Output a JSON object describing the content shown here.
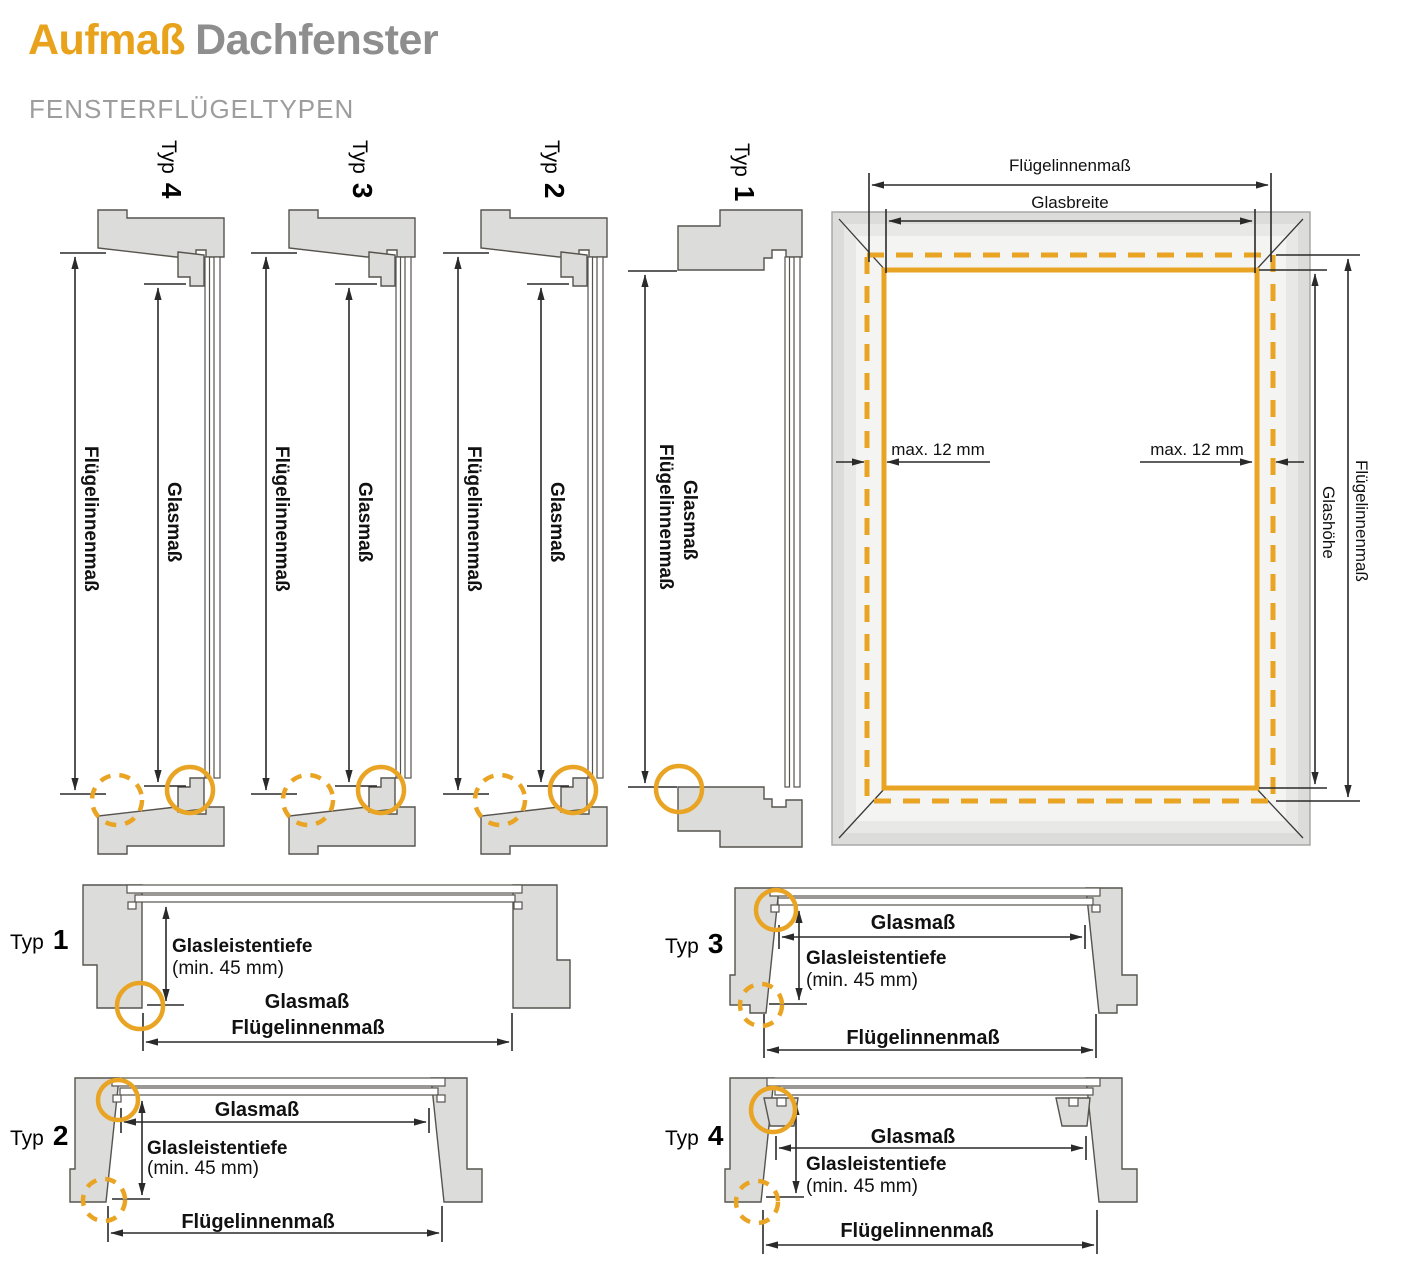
{
  "header": {
    "title_accent": "Aufmaß",
    "title_rest": "Dachfenster",
    "subtitle": "FENSTERFLÜGELTYPEN"
  },
  "profile_sections_top": [
    {
      "typ": "Typ",
      "num": "4",
      "dim_outer": "Flügelinnenmaß",
      "dim_inner": "Glasmaß"
    },
    {
      "typ": "Typ",
      "num": "3",
      "dim_outer": "Flügelinnenmaß",
      "dim_inner": "Glasmaß"
    },
    {
      "typ": "Typ",
      "num": "2",
      "dim_outer": "Flügelinnenmaß",
      "dim_inner": "Glasmaß"
    },
    {
      "typ": "Typ",
      "num": "1",
      "dim_outer": "Flügelinnenmaß",
      "dim_inner": "Glasmaß"
    }
  ],
  "front_view": {
    "dim_top_outer": "Flügelinnenmaß",
    "dim_top_inner": "Glasbreite",
    "dim_right_outer": "Flügelinnenmaß",
    "dim_right_inner": "Glashöhe",
    "gap_left": "max. 12 mm",
    "gap_right": "max. 12 mm"
  },
  "detail_sections_bottom": [
    {
      "typ": "Typ",
      "num": "1",
      "depth": "Glasleistentiefe",
      "depth_min": "(min. 45 mm)",
      "glass": "Glasmaß",
      "inner": "Flügelinnenmaß"
    },
    {
      "typ": "Typ",
      "num": "2",
      "depth": "Glasleistentiefe",
      "depth_min": "(min. 45 mm)",
      "glass": "Glasmaß",
      "inner": "Flügelinnenmaß"
    },
    {
      "typ": "Typ",
      "num": "3",
      "depth": "Glasleistentiefe",
      "depth_min": "(min. 45 mm)",
      "glass": "Glasmaß",
      "inner": "Flügelinnenmaß"
    },
    {
      "typ": "Typ",
      "num": "4",
      "depth": "Glasleistentiefe",
      "depth_min": "(min. 45 mm)",
      "glass": "Glasmaß",
      "inner": "Flügelinnenmaß"
    }
  ],
  "colors": {
    "accent_orange": "#E9A424",
    "title_orange": "#E9A21B",
    "title_gray": "#8E8E8E",
    "profile_fill": "#DCDCDA",
    "line_dark": "#2A2A2A"
  }
}
